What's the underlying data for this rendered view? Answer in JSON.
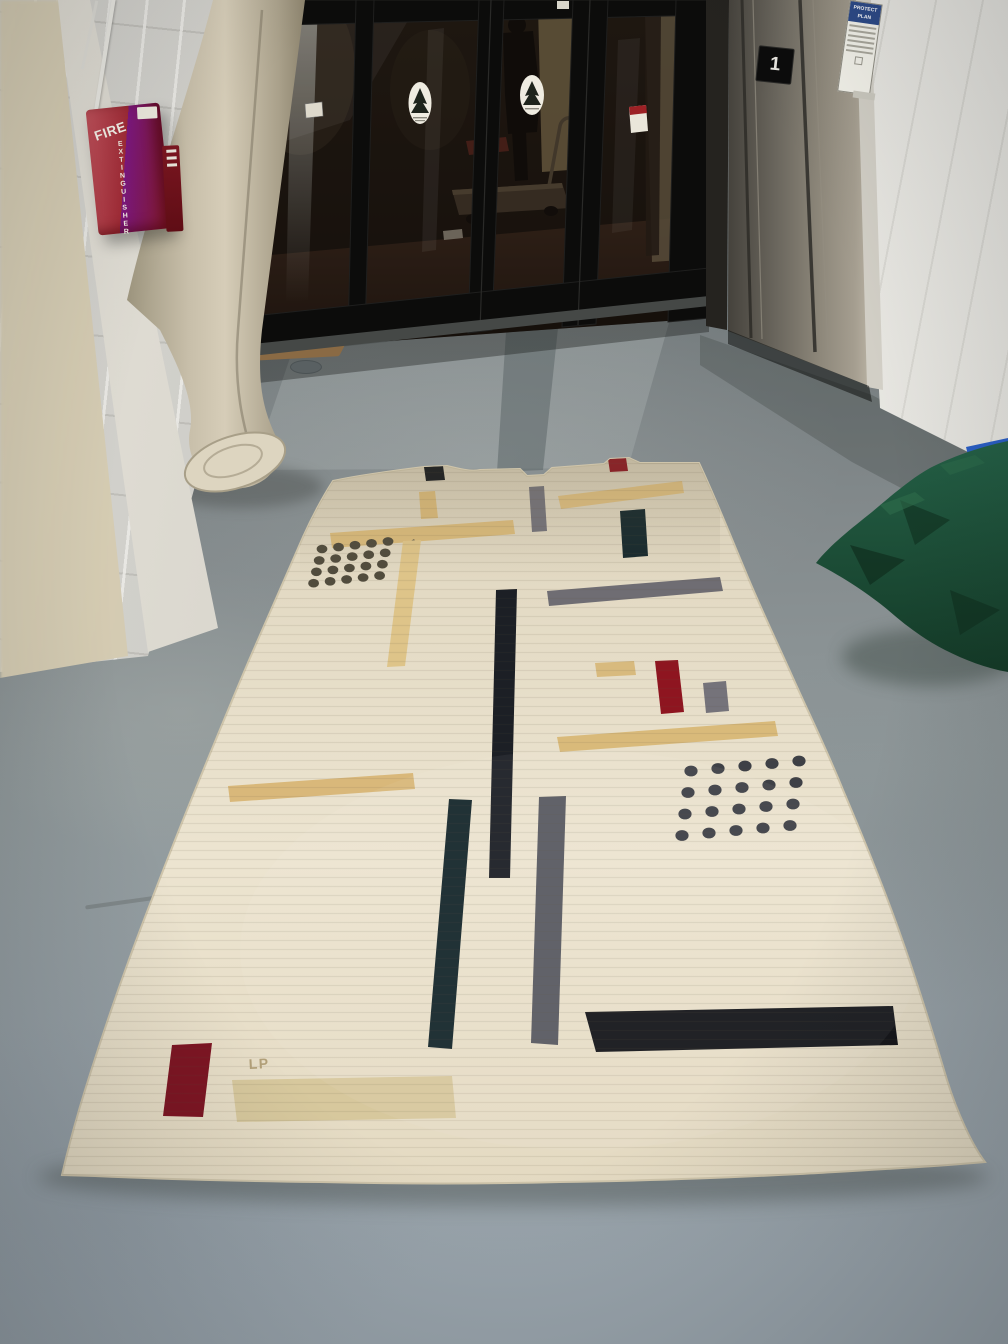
{
  "fire_cabinet": {
    "title": "FIRE",
    "subtitle": "EXTINGUISHER"
  },
  "elevator": {
    "floor_plaque": "1"
  },
  "wall_sign": {
    "header_line1": "PROTECT",
    "header_line2": "PLAN"
  },
  "rug": {
    "monogram": "LP"
  },
  "palette": {
    "rug_base": "#e9e1cc",
    "floor_gray": "#8d9598",
    "wall_white": "#d9d8d3",
    "door_frame_black": "#0d0d0c",
    "elevator_steel": "#7b766c",
    "fabric_green": "#1d5038",
    "cabinet_red": "#a12b36",
    "accent_red": "#8e1722",
    "accent_tan": "#d9ba7c",
    "accent_gray": "#75737a",
    "accent_black": "#1a1d22",
    "accent_teal": "#17282c"
  },
  "rug_pattern": {
    "bars": [
      {
        "name": "black-bar-top",
        "fill": "#171a1f",
        "points": "424,467 443,466 445,480 426,481"
      },
      {
        "name": "red-bar-top",
        "fill": "#8e1722",
        "points": "608,459 626,458 628,471 610,472"
      },
      {
        "name": "tan-bar-top-left-vertical",
        "fill": "#d9b97a",
        "points": "419,492 435,491 438,518 421,519"
      },
      {
        "name": "gray-bar-top-vertical",
        "fill": "#75737a",
        "points": "529,487 544,486 547,531 532,532"
      },
      {
        "name": "tan-bar-top-right",
        "fill": "#dcbd80",
        "points": "558,496 682,481 684,493 561,509"
      },
      {
        "name": "teal-bar-top-vertical",
        "fill": "#182a2e",
        "points": "620,511 645,509 648,556 623,558"
      },
      {
        "name": "tan-bar-upper-left",
        "fill": "#d9ba7c",
        "points": "330,533 513,520 515,534 332,548"
      },
      {
        "name": "olive-dash",
        "fill": "#6b6552",
        "points": "404,545 414,539 417,544 407,550"
      },
      {
        "name": "tan-bar-left-vertical-long",
        "fill": "#dec489",
        "points": "403,541 421,540 405,666 387,667"
      },
      {
        "name": "gray-bar-mid-right",
        "fill": "#6f6d73",
        "points": "547,591 720,577 723,591 549,606"
      },
      {
        "name": "black-bar-center-long",
        "fill": "#1c1f25",
        "points": "496,590 517,589 510,878 489,878"
      },
      {
        "name": "tan-rect-middle",
        "fill": "#d8ba7e",
        "points": "595,663 634,661 636,675 597,677"
      },
      {
        "name": "red-bar-middle-vertical",
        "fill": "#8e1520",
        "points": "655,661 678,660 684,712 661,714"
      },
      {
        "name": "gray-bar-middle-vertical",
        "fill": "#75737a",
        "points": "703,683 726,681 729,711 706,713"
      },
      {
        "name": "tan-bar-middle-right",
        "fill": "#d9ba7a",
        "points": "557,737 775,721 778,736 560,752"
      },
      {
        "name": "tan-bar-middle-left",
        "fill": "#d9b87a",
        "points": "228,786 413,773 415,789 230,802"
      },
      {
        "name": "teal-bar-bottom-vertical",
        "fill": "#16272c",
        "points": "449,799 472,800 452,1049 428,1047"
      },
      {
        "name": "gray-bar-bottom-vertical",
        "fill": "#595a61",
        "points": "539,797 566,796 558,1045 531,1043"
      },
      {
        "name": "black-bar-bottom",
        "fill": "#16171b",
        "points": "585,1012 893,1006 898,1045 596,1052"
      },
      {
        "name": "red-bar-bottom",
        "fill": "#7d1523",
        "points": "172,1045 212,1043 203,1117 163,1116"
      },
      {
        "name": "tan-bar-bottom",
        "fill": "#d7c89d",
        "points": "232,1080 452,1076 456,1118 237,1122"
      }
    ],
    "dot_grids": [
      {
        "name": "dot-grid-upper-left",
        "x": 322,
        "y": 549,
        "cols": 5,
        "rows": 4,
        "col_dx": 16.5,
        "col_dy": -1.9,
        "row_dx": -2.8,
        "row_dy": 11.4,
        "rx": 5.4,
        "ry": 4.3,
        "fill": "#514c3d"
      },
      {
        "name": "dot-grid-lower-right",
        "x": 691,
        "y": 771,
        "cols": 5,
        "rows": 4,
        "col_dx": 27,
        "col_dy": -2.5,
        "row_dx": -3,
        "row_dy": 21.5,
        "rx": 6.6,
        "ry": 5.4,
        "fill": "#3e4046"
      }
    ]
  }
}
